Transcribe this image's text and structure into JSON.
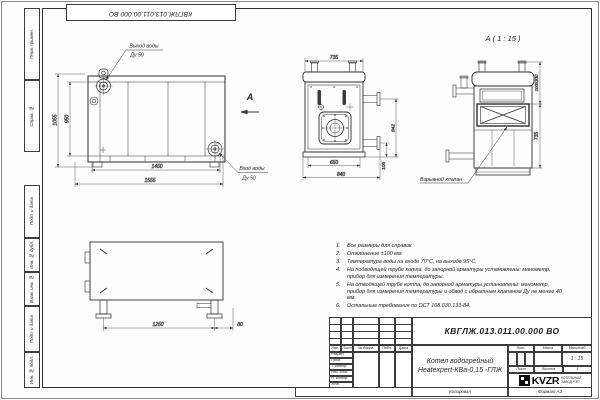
{
  "page": {
    "doc_number_top": "КВГЛЖ.013.011.00.000 ВО",
    "copied": "Копировал",
    "format": "Формат А3"
  },
  "margin": {
    "labels": [
      "Перв. примен.",
      "Справ. №",
      "Подп. и дата",
      "Инв. № дубл.",
      "Взам. инв. №",
      "Подп. и дата",
      "Инв. № подл."
    ]
  },
  "views": {
    "side": {
      "outlet_line1": "Выход воды",
      "outlet_line2": "Ду 50",
      "inlet_line1": "Вход воды",
      "inlet_line2": "Ду 50",
      "view_arrow": "А",
      "dim_height_outer": "1055",
      "dim_height_inner": "950",
      "dim_width_inner": "1450",
      "dim_width_outer": "1555"
    },
    "front": {
      "dim_top": "735",
      "dim_bottom_inner": "650",
      "dim_bottom_outer": "840",
      "dim_right_upper": "842",
      "dim_right_lower": "105"
    },
    "detail": {
      "title": "А ( 1 : 15 )",
      "dim_opening": "100х200",
      "dim_height": "735",
      "callout": "Взрывной клапан"
    },
    "plan": {
      "dim_length": "1250",
      "dim_offset": "80"
    }
  },
  "notes": {
    "items": [
      {
        "n": "1.",
        "text": "Все размеры для справок."
      },
      {
        "n": "2.",
        "text": "Отклонение ±100 мм."
      },
      {
        "n": "3.",
        "text": "Температура воды на входе 70°С, на выходе 95°С."
      },
      {
        "n": "4.",
        "text": "На подводящей трубе котла, до запорной арматуры установлены: манометр, прибор для измерения температуры."
      },
      {
        "n": "5.",
        "text": "На отводящей трубе котла, до запорной арматуры установлены: манометр, прибор для измерения температуры и обвод с обратным клапаном Ду не менее 40 мм."
      },
      {
        "n": "6.",
        "text": "Остальные требования по ОСТ 108.030.133-84."
      }
    ]
  },
  "title_block": {
    "doc_number": "КВГЛЖ.013.011.00.000 ВО",
    "name_line1": "Котел водогрейный",
    "name_line2": "Heatexpert-КВа-0,15 -ГЛЖ",
    "header_cols": [
      "Изм.",
      "Лист",
      "№ докум.",
      "Подп.",
      "Дата"
    ],
    "sig_rows": [
      "Разраб.",
      "Пров.",
      "Т. контр.",
      "Нач. отд.",
      "Н. контр.",
      "Утв."
    ],
    "lit_label": "Лит.",
    "mass_label": "Масса",
    "scale_label": "Масштаб",
    "scale_value": "1 : 15",
    "sheet_label": "Лист",
    "sheets_label": "Листов",
    "sheets_value": "1",
    "logo_text": "KVZR",
    "logo_caption1": "КОТЕЛЬНЫЙ",
    "logo_caption2": "ЗАВОД РЭП"
  }
}
